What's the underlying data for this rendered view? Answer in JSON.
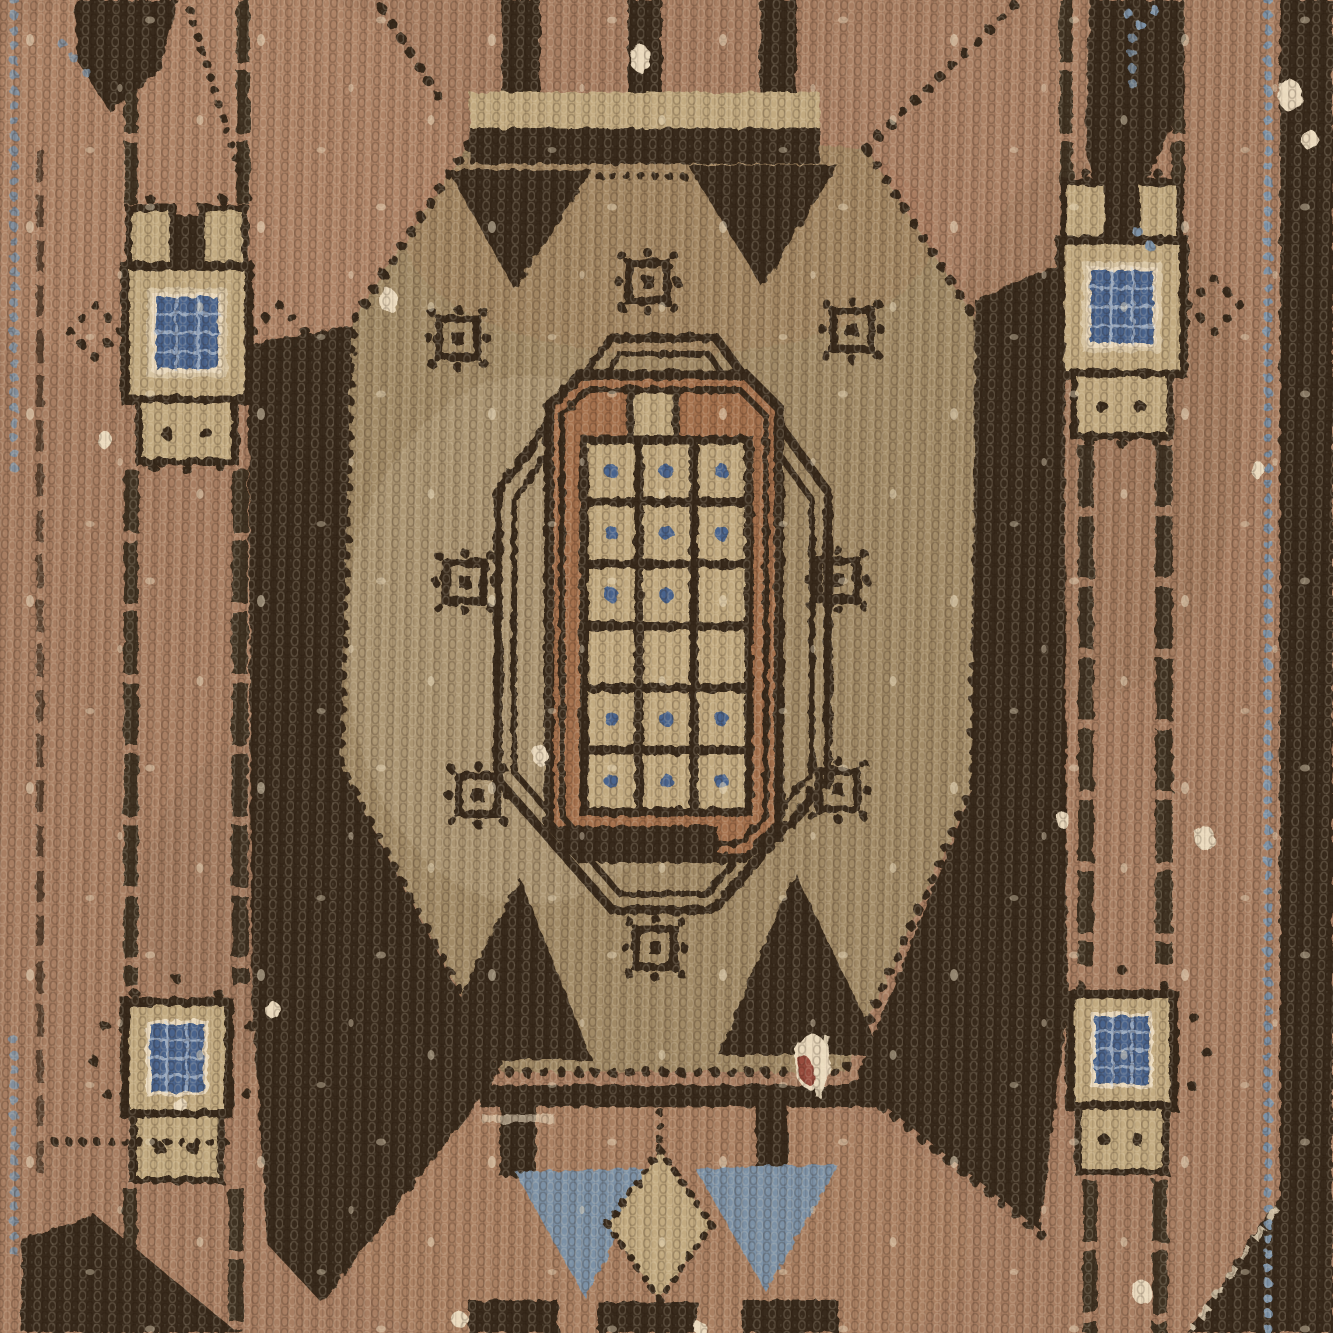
{
  "scene": {
    "subject": "Macro close-up photograph of a worn vintage hand-knotted wool rug",
    "pattern": "Geometric tribal octagonal medallion flanked by guard stripes with latch-hook pole motifs",
    "texture": "knotted wool pile, abrash shading, worn cream foundation spots, one red fiber stain"
  },
  "palette": {
    "field_rose": "#a87e62",
    "field_rose_light": "#c49c7c",
    "field_khaki": "#a18a66",
    "field_khaki_light": "#c2aa80",
    "dark_brown": "#372a1b",
    "brown_mid": "#6b5338",
    "salmon": "#a5714e",
    "cream": "#ead9bd",
    "steel_blue": "#7b91a6",
    "navy_blue": "#4a648c",
    "rust_red": "#8e3b2e"
  },
  "medallion": {
    "shape": "octagon with dotted (knot-by-knot) outline",
    "rosettes": 8,
    "top_triangles": 2,
    "bottom_triangles": 2,
    "grid": {
      "rows": 6,
      "cols": 3,
      "blue_dot_cells": [
        [
          1,
          1
        ],
        [
          1,
          2
        ],
        [
          1,
          3
        ],
        [
          2,
          1
        ],
        [
          2,
          2
        ],
        [
          2,
          3
        ],
        [
          3,
          1
        ],
        [
          3,
          2
        ],
        [
          5,
          1
        ],
        [
          5,
          2
        ],
        [
          5,
          3
        ],
        [
          6,
          1
        ],
        [
          6,
          2
        ],
        [
          6,
          3
        ]
      ]
    }
  },
  "guard_stripes": {
    "left": {
      "motifs": 2,
      "blue_panels": 2
    },
    "right": {
      "motifs": 2,
      "blue_panels": 2
    }
  },
  "pendant": {
    "blue_triangles": 2,
    "kite": 1
  },
  "edges": {
    "left_blue_dotted_line": true,
    "right_blue_dotted_line": true,
    "right_dark_band": true,
    "corner_dark_patches": 4
  }
}
